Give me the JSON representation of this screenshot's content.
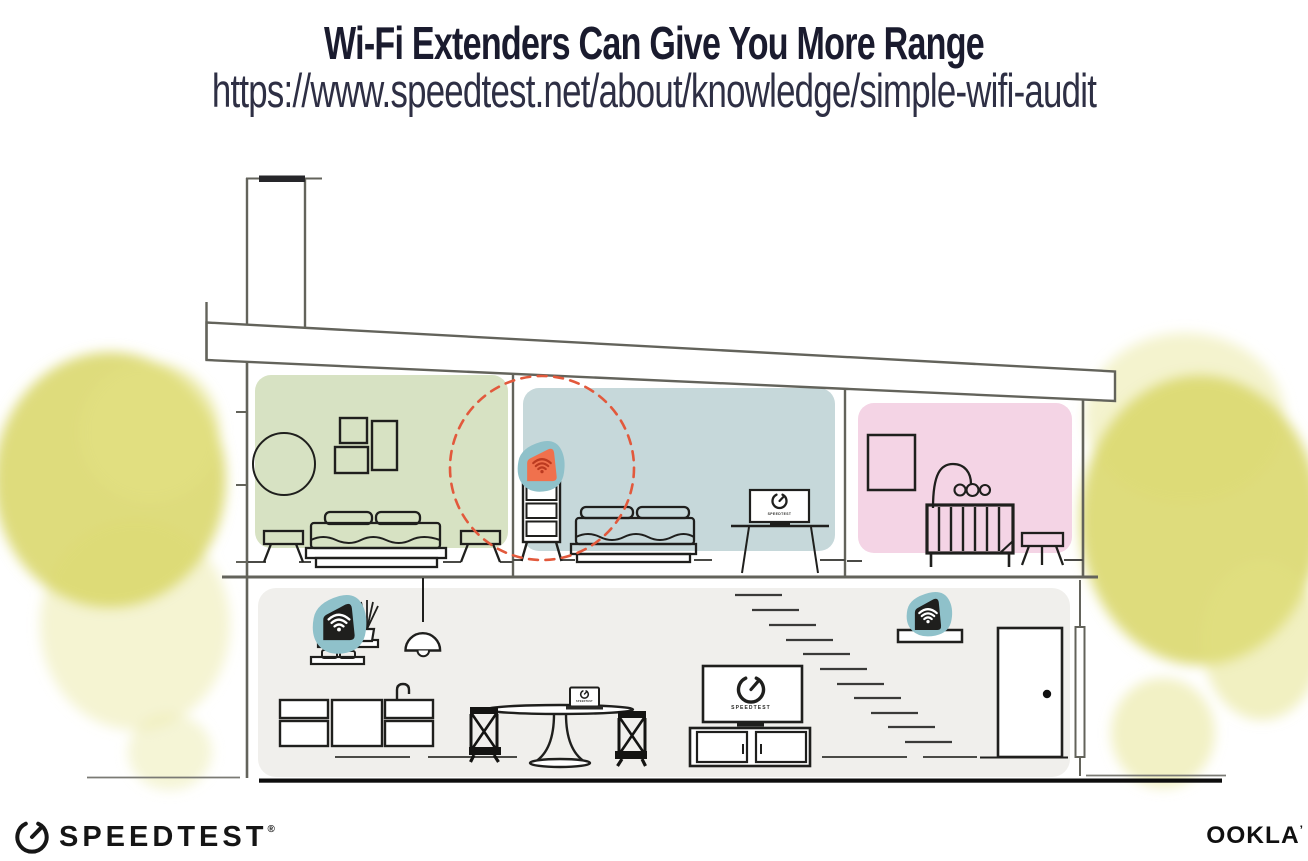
{
  "header": {
    "title": "Wi-Fi Extenders Can Give You More Range",
    "subtitle_url": "https://www.speedtest.net/about/knowledge/simple-wifi-audit"
  },
  "screens": {
    "bedroom_tv_label": "SPEEDTEST",
    "living_tv_label": "SPEEDTEST",
    "laptop_label": "SPEEDTEST"
  },
  "footer": {
    "speedtest_wordmark": "SPEEDTEST",
    "speedtest_reg_mark": "®",
    "ookla_wordmark": "OOKLA",
    "ookla_reg_mark": "’"
  },
  "icons": {
    "gauge": "speedtest-gauge-icon",
    "wifi": "wifi-icon"
  },
  "colors": {
    "title_navy": "#1a1b2e",
    "room_green": "#d7e2c3",
    "room_blue": "#c6d8da",
    "room_pink": "#f4d4e5",
    "lower_floor_gray": "#f0efec",
    "device_teal": "#8fc1ca",
    "extender_orange": "#f0714d",
    "wifi_on_orange": "#bb3a20",
    "range_circle_red": "#e2593c",
    "foliage_yellow": "#dad86e",
    "structure_line": "#63635b",
    "ink": "#1f1f1d"
  }
}
